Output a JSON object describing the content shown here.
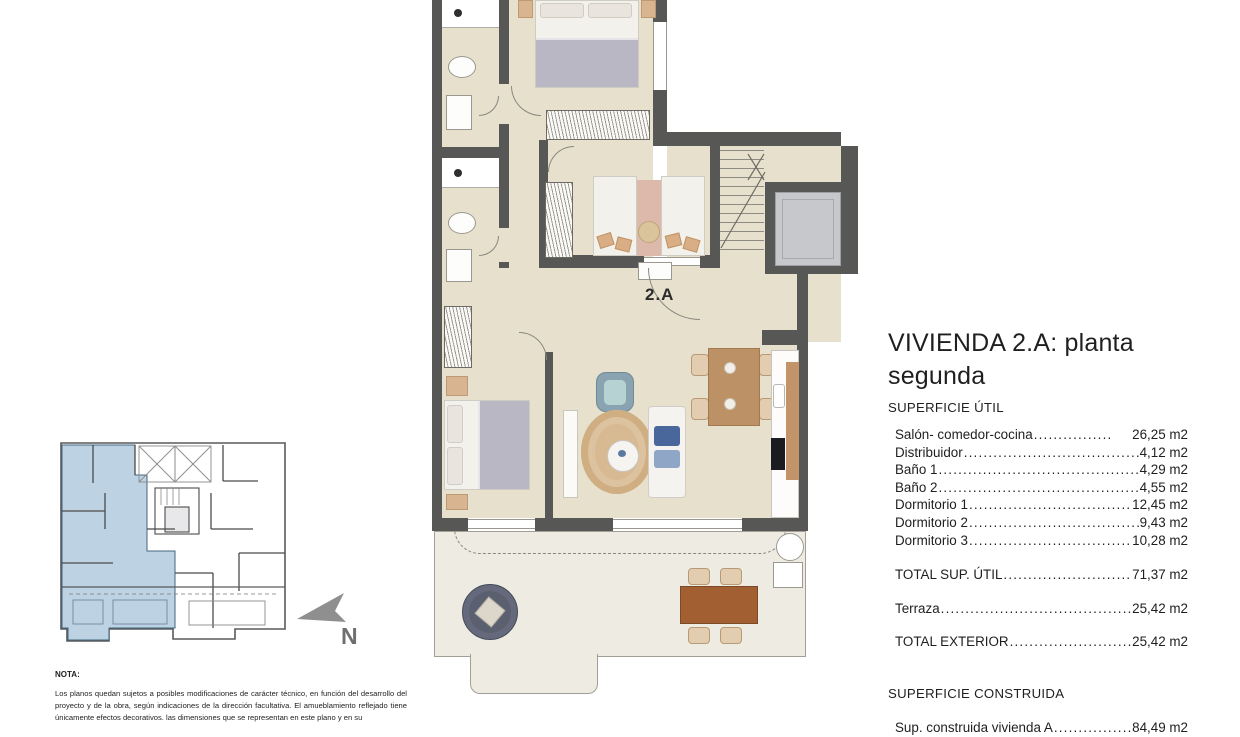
{
  "plan": {
    "unit_label": "2.A"
  },
  "compass": {
    "label": "N"
  },
  "panel": {
    "title": "VIVIENDA 2.A: planta segunda",
    "superficie_util_heading": "SUPERFICIE ÚTIL",
    "util_rows": [
      {
        "label": "Salón- comedor-cocina",
        "value": "26,25 m2"
      },
      {
        "label": "Distribuidor",
        "value": "4,12 m2"
      },
      {
        "label": "Baño 1",
        "value": "4,29 m2"
      },
      {
        "label": "Baño 2",
        "value": "4,55 m2"
      },
      {
        "label": "Dormitorio 1",
        "value": "12,45 m2"
      },
      {
        "label": "Dormitorio 2",
        "value": "9,43 m2"
      },
      {
        "label": "Dormitorio 3",
        "value": "10,28 m2"
      }
    ],
    "total_util": {
      "label": "TOTAL SUP. ÚTIL",
      "value": "71,37 m2"
    },
    "terraza": {
      "label": "Terraza",
      "value": "25,42 m2"
    },
    "total_exterior": {
      "label": "TOTAL EXTERIOR",
      "value": "25,42 m2"
    },
    "superficie_construida_heading": "SUPERFICIE CONSTRUIDA",
    "construida": {
      "label": "Sup. construida vivienda A",
      "value": "84,49 m2"
    }
  },
  "note": {
    "heading": "NOTA:",
    "body": "Los planos quedan sujetos a posibles modificaciones de carácter técnico, en función del desarrollo del proyecto y de la obra, según indicaciones de la dirección facultativa. El amueblamiento reflejado tiene únicamente efectos decorativos. las dimensiones que se representan en este plano y en su"
  },
  "colors": {
    "wall": "#575756",
    "floor": "#e7e0cd",
    "terrace_floor": "#edebe2",
    "keyplan_highlight": "#bdd2e3",
    "text": "#1f1f1f"
  }
}
